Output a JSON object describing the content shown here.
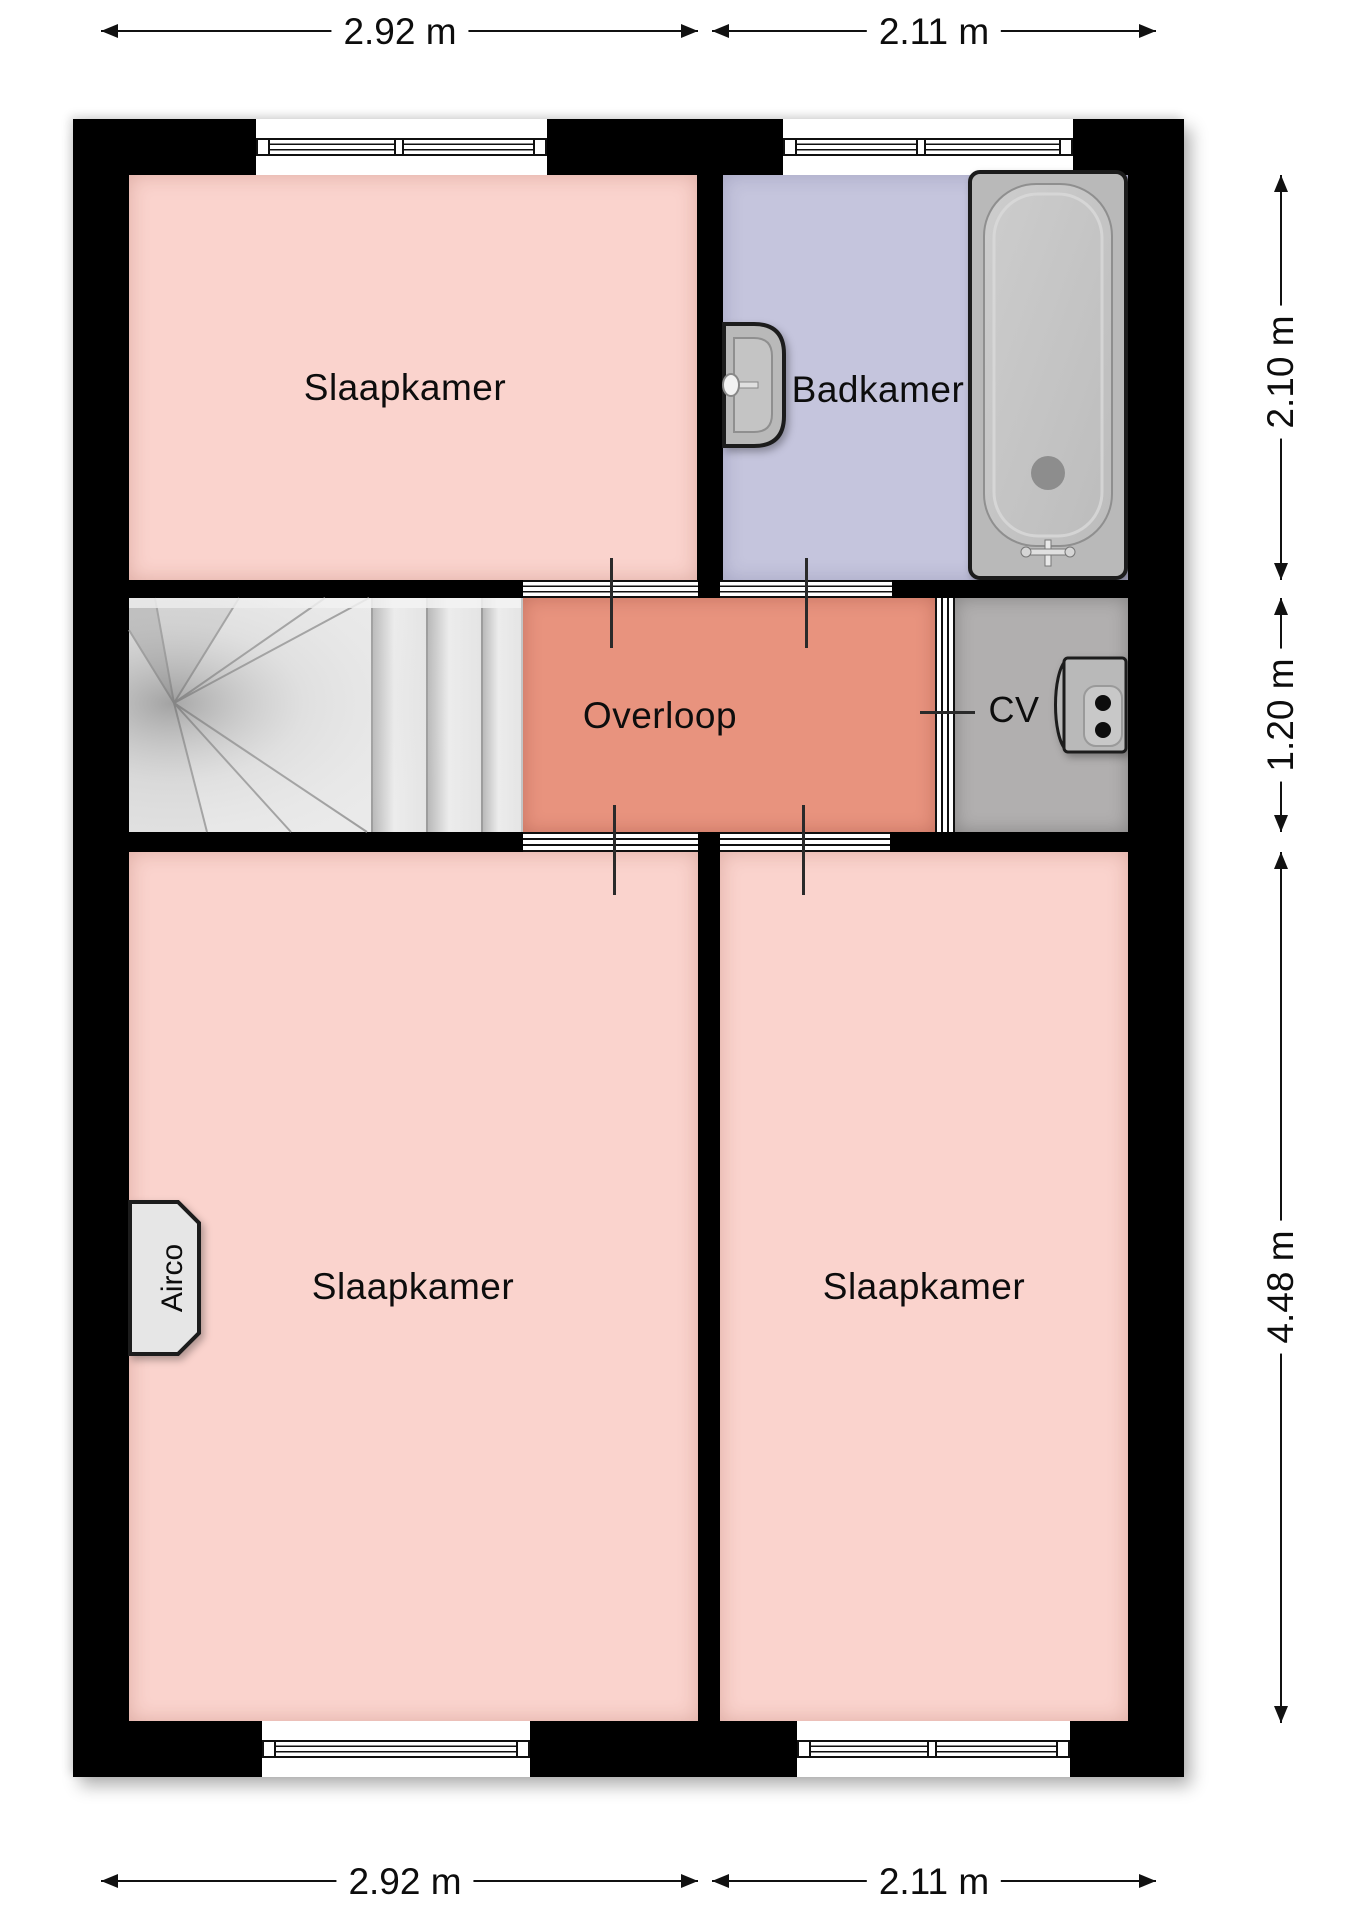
{
  "colors": {
    "wall": "#000000",
    "bedroom": "#fad3cd",
    "bathroom": "#c5c5dd",
    "landing": "#e8937e",
    "utility": "#b1afaf",
    "stairs": "#eaeaea",
    "fixture": "#b9b9b9",
    "dimension": "#111111"
  },
  "rooms": {
    "bedroom_top": {
      "label": "Slaapkamer"
    },
    "bathroom": {
      "label": "Badkamer"
    },
    "landing": {
      "label": "Overloop"
    },
    "utility": {
      "label": "CV"
    },
    "bedroom_bottom_left": {
      "label": "Slaapkamer"
    },
    "bedroom_bottom_right": {
      "label": "Slaapkamer"
    }
  },
  "fixtures": {
    "airco": {
      "label": "Airco"
    },
    "stairs": {
      "name": "winder-staircase"
    },
    "bathtub": {
      "name": "bathtub"
    },
    "sink": {
      "name": "wash-basin"
    },
    "boiler": {
      "name": "cv-boiler"
    }
  },
  "dimensions": {
    "top": [
      {
        "label": "2.92 m"
      },
      {
        "label": "2.11 m"
      }
    ],
    "bottom": [
      {
        "label": "2.92 m"
      },
      {
        "label": "2.11 m"
      }
    ],
    "right": [
      {
        "label": "2.10 m"
      },
      {
        "label": "1.20 m"
      },
      {
        "label": "4.48 m"
      }
    ]
  }
}
